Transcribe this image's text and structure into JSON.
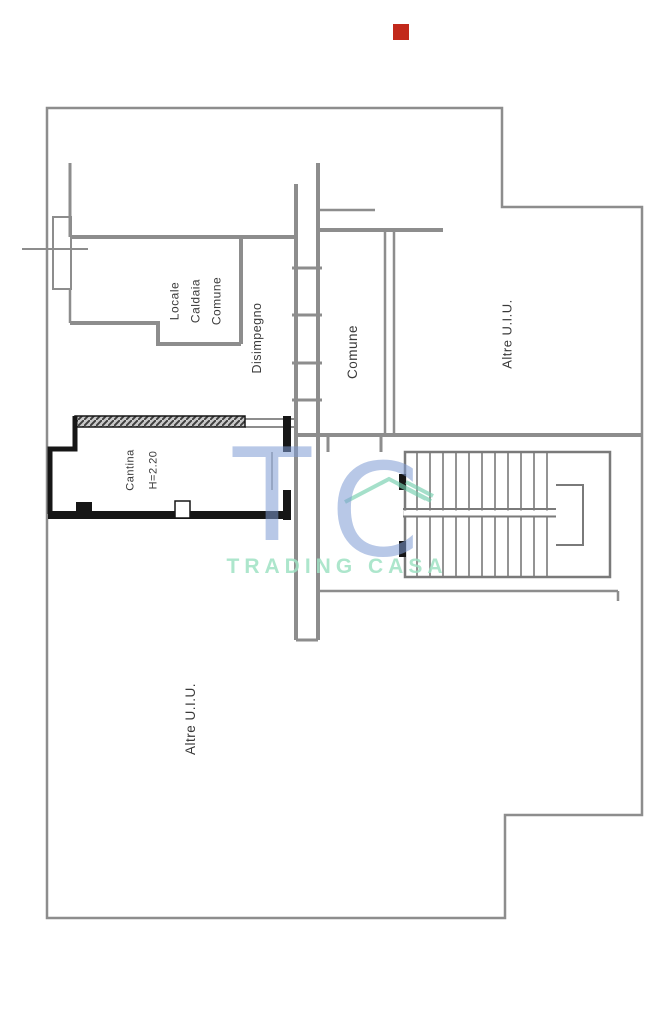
{
  "plan": {
    "rooms": {
      "locale_caldaia": "Locale\nCaldaia\nComune",
      "disimpegno": "Disimpegno",
      "comune": "Comune",
      "altre_top": "Altre U.I.U.",
      "altre_bottom": "Altre U.I.U.",
      "cantina": "Cantina",
      "cantina_height": "H=2.20"
    },
    "marker_color": "#c2291b",
    "wall_color": "#8d8d8d",
    "thick_wall_color": "#161616"
  },
  "watermark": {
    "t": "T",
    "c": "C",
    "name": "TRADING CASA",
    "blue": "#7d9ad4",
    "green": "#74cfae",
    "text_green": "#9fe2c4"
  }
}
